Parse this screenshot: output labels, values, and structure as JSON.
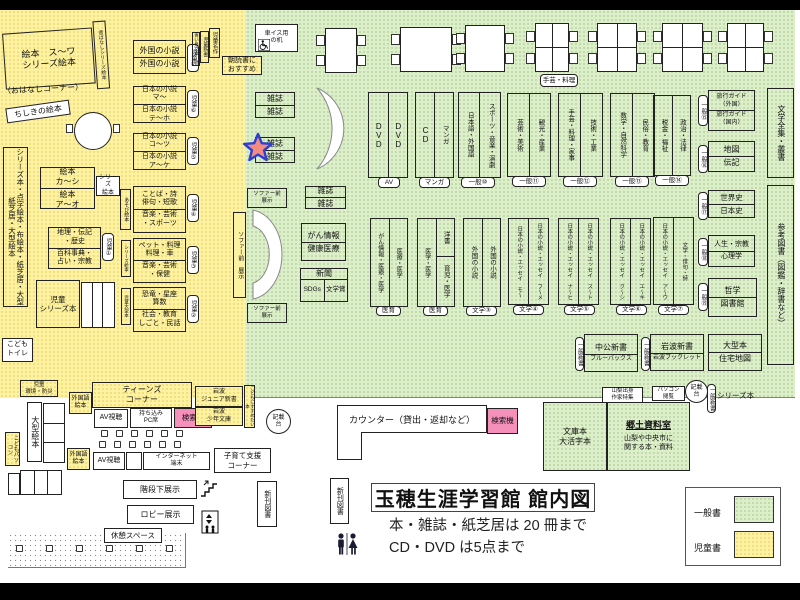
{
  "title": {
    "main": "玉穂生涯学習館 館内図",
    "note1": "本・雑誌・紙芝居は 20 冊まで",
    "note2": "CD・DVD は5点まで"
  },
  "legend": {
    "general": "一般書",
    "children": "児童書"
  },
  "colors": {
    "general": "#ddeecb",
    "children": "#fdf2a1",
    "pink": "#f590bb",
    "star": "#f28b82",
    "star_outline": "#2b3fd0"
  },
  "kids": {
    "ohanashi1": "絵本　ス〜ワ",
    "ohanashi2": "シリーズ絵本",
    "ohanashi_cap": "（おはなしコーナー）",
    "mukashi": "昔ばなしシリーズ絵本",
    "chishiki": "ちしきの絵本",
    "aoitori": "青い鳥文庫・他",
    "shinsho": "児童新書",
    "meisaku": "児童名作",
    "asadoku1": "朝読書に",
    "asadoku2": "おすすめ",
    "foreign1": "外国の小説",
    "foreign2": "外国の小説",
    "tag_j7": "児童⑦",
    "jp1_1": "日本の小説",
    "jp1_2": "マ〜",
    "jp1_3": "日本の小説",
    "jp1_4": "テ〜ホ",
    "tag_j6": "児童⑥",
    "jp2_1": "日本の小説",
    "jp2_2": "コ〜ツ",
    "jp2_3": "日本の小説",
    "jp2_4": "ア〜ケ",
    "tag_j5": "児童⑤",
    "kotoba1": "ことば・詩",
    "kotoba2": "俳句・短歌",
    "kotoba3": "音楽・芸術",
    "kotoba4": "・スポーツ",
    "tag_j4": "児童④",
    "side_asobi": "あそび絵本",
    "pet1": "ペット・料理",
    "pet2": "料理・車",
    "pet3": "音楽・芸術",
    "pet4": "・保健",
    "tag_j3": "児童③",
    "side_series": "シリーズ絵本",
    "dino1": "恐竜・星座",
    "dino2": "算数",
    "dino3": "社会・教育",
    "dino4": "しごと・民話",
    "tag_j2": "児童②",
    "side_ogata": "児童大型本",
    "ehon1": "絵本",
    "ehon2": "カ〜シ",
    "ehon3": "絵本",
    "ehon4": "ア〜オ",
    "ehon_tag1": "シリーズ",
    "ehon_tag2": "絵本",
    "chiri1": "地理・伝記",
    "chiri2": "・歴史",
    "chiri3": "百科事典・",
    "chiri4": "占い・宗教",
    "tag_j1": "児童①",
    "left_long": "シリーズ本・点字絵本・布絵本・紙芝居・大型紙芝居・大型絵本",
    "series1": "児童",
    "series2": "シリーズ本",
    "toilet1": "こども",
    "toilet2": "トイレ",
    "kankyo1": "児童",
    "kankyo2": "環境・防災",
    "ogata_ehon": "大型絵本",
    "kodomo_pc": "こどもパソコン",
    "gaikoku1": "外国語",
    "gaikoku2": "絵本"
  },
  "teens": {
    "header1": "ティーンズ",
    "header2": "コーナー",
    "av": "AV視聴",
    "pc1": "持ち込み",
    "pc2": "PC席",
    "jr1": "岩波",
    "jr2": "ジュニア新書",
    "syonen1": "岩波",
    "syonen2": "少年文庫",
    "susume": "こどもにすすめたい本",
    "internet1": "インターネット",
    "internet2": "端末",
    "kosodate1": "子育て支援",
    "kosodate2": "コーナー"
  },
  "displays": {
    "kaidan": "階段下展示",
    "lobby": "ロビー展示",
    "kyukei": "休憩スペース",
    "shinkan": "新刊図書"
  },
  "misc": {
    "kisai1": "記載",
    "kisai2": "台",
    "kensaku": "検索機"
  },
  "gen": {
    "wheel1": "車イス用",
    "wheel2": "の机",
    "mag": "雑誌",
    "gan1": "がん情報",
    "gan2": "健康医療",
    "news": "新聞",
    "sdgs": "SDGs",
    "prize": "文学賞",
    "sofa_v": "ソファー前　展示",
    "sofa1": "ソファー前",
    "sofa2": "展示",
    "shugei_tag": "手芸・料理",
    "a1c1": "DVD",
    "a1c2": "DVD",
    "a1t": "AV",
    "a2c1": "CD",
    "a2c2": "マンガ",
    "a2t": "マンガ",
    "a3c1": "日本語・外国語",
    "a3c2": "スポーツ・音楽・演劇",
    "a3t": "一般⑩",
    "a4c1": "芸術・美術",
    "a4c2": "観光・産業",
    "a4t": "一般⑪",
    "a5c1": "手芸・料理・家事",
    "a5c2": "技術・工業",
    "a5t": "一般⑫",
    "a6c1": "数学・自然科学",
    "a6c2": "民俗・教育",
    "a6t": "一般⑬",
    "a7c1": "税金・福祉",
    "a7c2": "政治・法律",
    "a7t": "一般⑭",
    "r1l1": "旅行ガイド",
    "r1l2": "（外国）",
    "r1l3": "旅行ガイド",
    "r1l4": "（国内）",
    "r1t": "一般⑮",
    "r2l1": "地図",
    "r2l2": "伝記",
    "r2t": "一般⑯",
    "r3l1": "世界史",
    "r3l2": "日本史",
    "r3t": "一般⑰",
    "r4l1": "人生・宗教",
    "r4l2": "心理学",
    "r4t": "一般⑱",
    "r5l1": "哲学",
    "r5l2": "図書館",
    "r5t": "一般⑲",
    "fr1": "文学全集・叢書",
    "fr2": "参考図書（図鑑・辞書など）",
    "b1c1": "がん情報・医療・医学",
    "b1c2": "医療・医学",
    "b1t": "医育",
    "b2c1": "医学・医学",
    "b2c2a": "洋書",
    "b2c2b": "育児・医学",
    "b3c1": "外国の小説",
    "b3c2": "外国の小説",
    "b3t": "文学③",
    "b4c1": "日本の小説・エッセイ　モ〜",
    "b4c2": "日本の小説・エッセイ　フ〜メ",
    "b4t": "文学④",
    "b5c1": "日本の小説・エッセイ　ナ〜ヒ",
    "b5c2": "日本の小説・エッセイ　ス〜ト",
    "b5t": "文学⑤",
    "b6c1": "日本の小説・エッセイ　ク〜シ",
    "b6c2": "日本の小説・エッセイ　エ〜キ",
    "b6t": "文学⑥",
    "b7c1": "日本の小説・エッセイ　ア〜ウ",
    "b7c2": "文学・俳句・詩",
    "b7t": "文学⑦",
    "shinsho_tag": "一般新書",
    "c1l1": "中公新書",
    "c1l2": "ブルーバックス",
    "c2l1": "岩波新書",
    "c2l2": "岩波ブックレット",
    "c3l1": "大型本",
    "c3l2": "住宅地図",
    "d1a": "山梨出身",
    "d1b": "作家特集",
    "d2a": "パソコン",
    "d2b": "閲覧",
    "d5": "シリーズ本",
    "counter": "カウンター（貸出・返却など）",
    "bunko1": "文庫本",
    "bunko2": "大活字本",
    "kyodo_t": "郷土資料室",
    "kyodo1": "山梨や中央市に",
    "kyodo2": "関する本・資料"
  }
}
